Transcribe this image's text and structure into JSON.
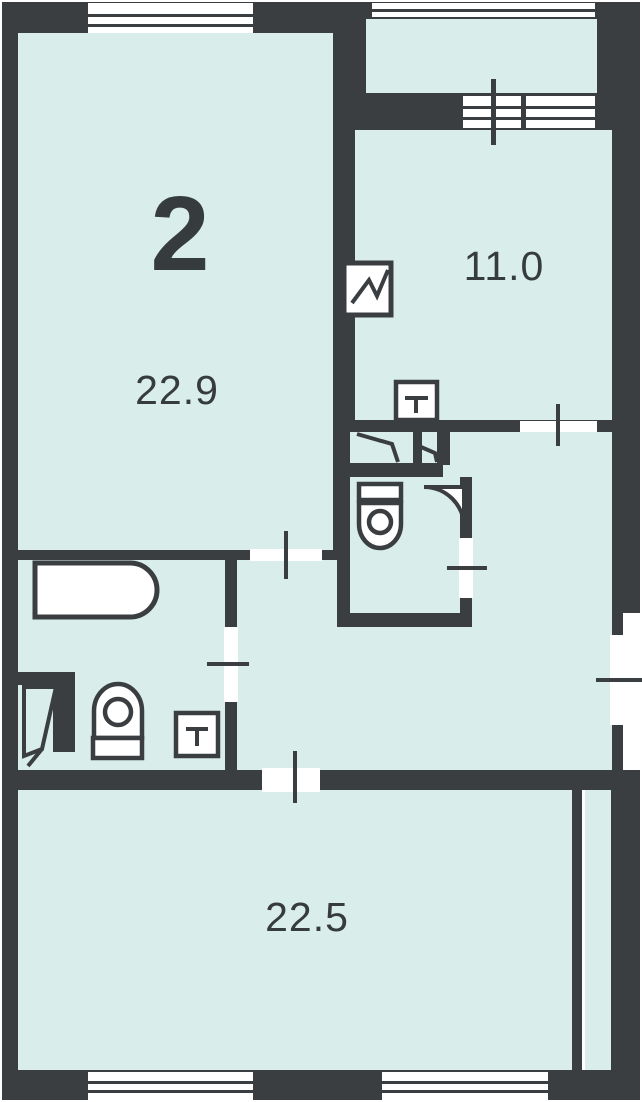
{
  "plan": {
    "apartment_number": "2",
    "rooms": [
      {
        "id": "room-top-left",
        "area": "22.9"
      },
      {
        "id": "room-top-right",
        "area": "11.0"
      },
      {
        "id": "room-bottom",
        "area": "22.5"
      }
    ],
    "fixtures": {
      "bathtub_count": 1,
      "toilet_count": 2,
      "washbasin_count": 2,
      "stove_icon": "zigzag-square",
      "wardrobe_icon": "angled-door-leaves",
      "entrance_door_icon": "angled-door-leaf",
      "balcony": "top-right-with-railing"
    },
    "windows": {
      "top": 2,
      "bottom": 2,
      "balcony_door": 1
    },
    "colors": {
      "wall": "#3a3e41",
      "room_fill": "#d9edeb",
      "fixture_fill": "#ffffff",
      "label_text": "#363b3e"
    }
  }
}
